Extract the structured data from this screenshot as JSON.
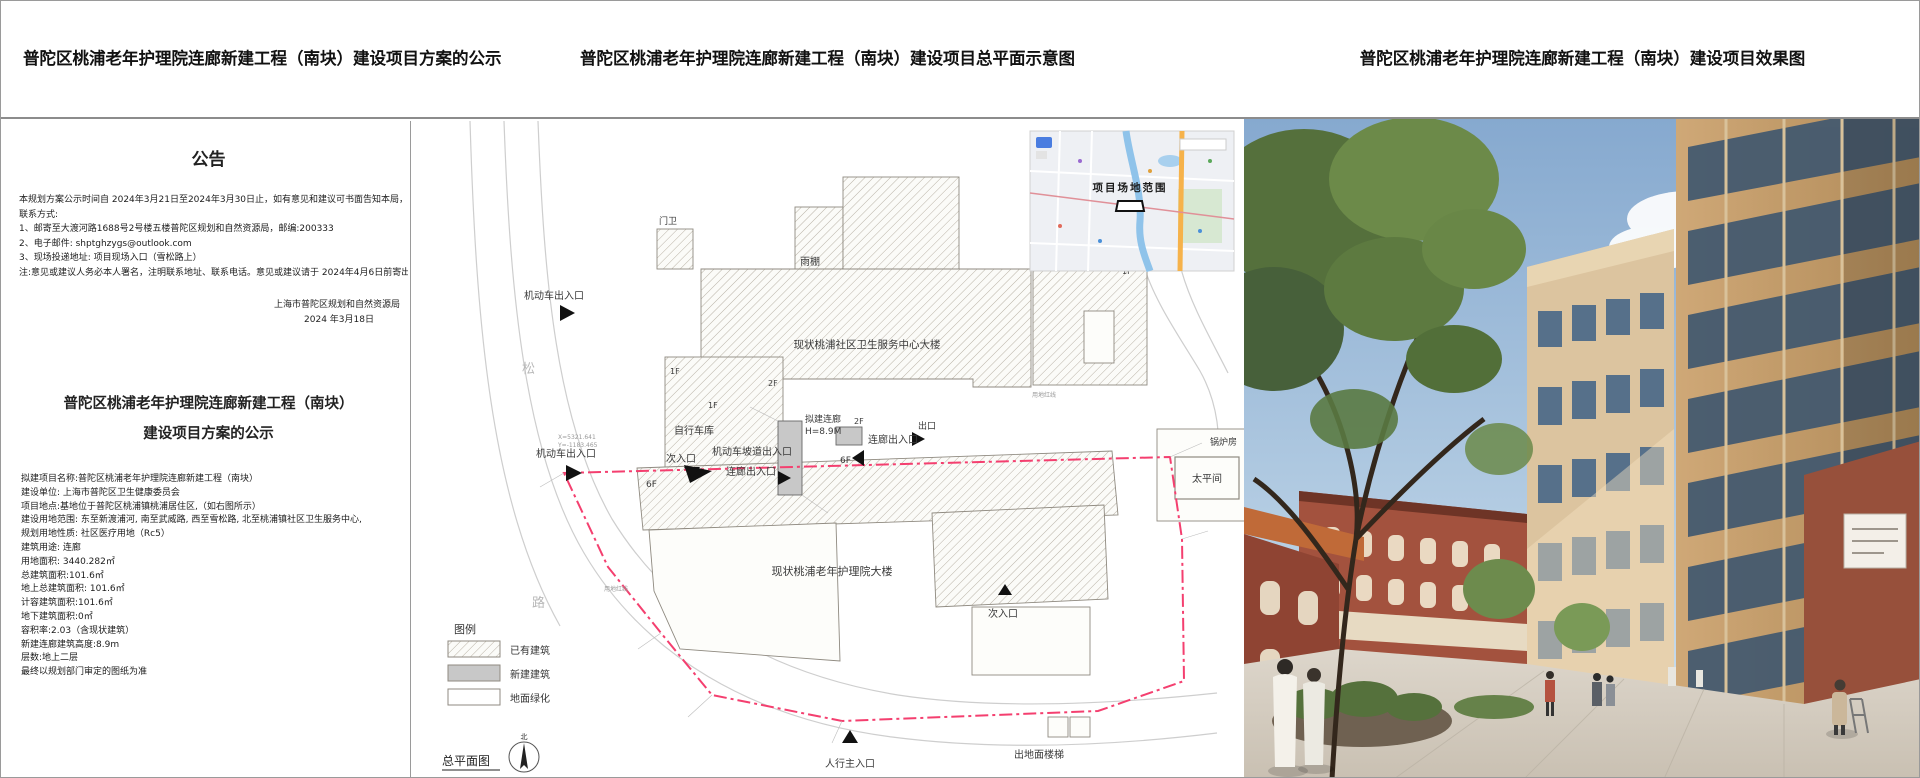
{
  "headers": {
    "left": "普陀区桃浦老年护理院连廊新建工程（南块）建设项目方案的公示",
    "middle": "普陀区桃浦老年护理院连廊新建工程（南块）建设项目总平面示意图",
    "right": "普陀区桃浦老年护理院连廊新建工程（南块）建设项目效果图"
  },
  "notice": {
    "title": "公告",
    "body_lines": [
      "本规划方案公示时间自 2024年3月21日至2024年3月30日止，如有意见和建议可书面告知本局，希望得到监督和支持。",
      "联系方式:",
      "1、邮寄至大渡河路1688号2号楼五楼普陀区规划和自然资源局，邮编:200333",
      "2、电子邮件: shptghzygs@outlook.com",
      "3、现场投递地址: 项目现场入口（雪松路上）",
      "注:意见或建议人务必本人署名，注明联系地址、联系电话。意见或建议请于 2024年4月6日前寄出，逾期不受理"
    ],
    "signature": "上海市普陀区规划和自然资源局",
    "date": "2024 年3月18日",
    "project_title_line1": "普陀区桃浦老年护理院连廊新建工程（南块）",
    "project_title_line2": "建设项目方案的公示",
    "details": [
      "拟建项目名称:普陀区桃浦老年护理院连廊新建工程（南块）",
      "建设单位: 上海市普陀区卫生健康委员会",
      "项目地点:基地位于普陀区桃浦镇桃浦居住区,（如右图所示）",
      "建设用地范围: 东至新渡浦河, 南至武威路, 西至雪松路, 北至桃浦镇社区卫生服务中心,",
      "规划用地性质: 社区医疗用地（Rc5）",
      "建筑用途: 连廊",
      "用地面积: 3440.282㎡",
      "总建筑面积:101.6㎡",
      "地上总建筑面积: 101.6㎡",
      "计容建筑面积:101.6㎡",
      "地下建筑面积:0㎡",
      "容积率:2.03（含现状建筑）",
      "新建连廊建筑高度:8.9m",
      "层数:地上二层",
      "最终以规划部门审定的图纸为准"
    ]
  },
  "site_plan": {
    "caption": "总平面图",
    "north_label": "北",
    "map_inset": {
      "label": "项目场地范围"
    },
    "legend": {
      "title": "图例",
      "existing": "已有建筑",
      "new": "新建建筑",
      "greening": "地面绿化"
    },
    "labels": {
      "gate": "门卫",
      "canopy": "雨棚",
      "vehicle_entrance": "机动车出入口",
      "ramp_entrance": "机动车坡道出入口",
      "bike_garage": "自行车库",
      "health_center": "现状桃浦社区卫生服务中心大楼",
      "boiler": "锅炉房",
      "mortuary": "太平间",
      "corridor_exit": "连廊出入口",
      "secondary_entrance": "次入口",
      "exit": "出口",
      "new_corridor": "拟建连廊",
      "new_corridor_height": "H=8.9M",
      "nursing_home": "现状桃浦老年护理院大楼",
      "main_entrance": "人行主入口",
      "ground_stairs": "出地面楼梯",
      "red_line": "用地红线",
      "road_char_song": "松",
      "road_char_lu": "路",
      "f1": "1F",
      "f2": "2F",
      "f6": "6F",
      "coord_x": "X=5321.641",
      "coord_y": "Y=-1183.465"
    },
    "colors": {
      "boundary": "#f43f6f",
      "new_building": "#c8c8c8"
    }
  },
  "rendering": {
    "colors": {
      "sky_top": "#86a9cf",
      "sky_bottom": "#d4e4f1",
      "facade_tan": "#c9a271",
      "building_beige": "#dcc49f",
      "brick_red": "#a3523e",
      "pavement": "#d8d2c7"
    }
  }
}
